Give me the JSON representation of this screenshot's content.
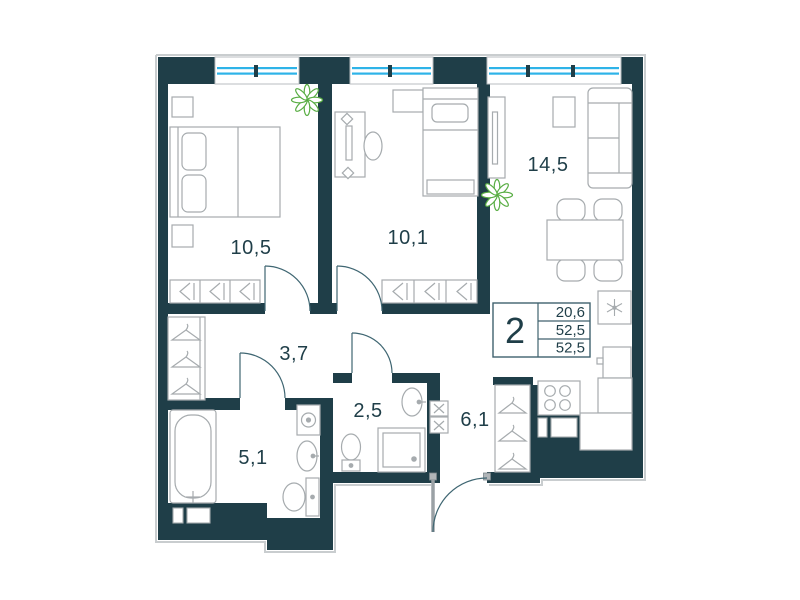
{
  "summary": {
    "rooms_count": "2",
    "area_living": "20,6",
    "area_total": "52,5",
    "area_declared": "52,5"
  },
  "rooms": {
    "bedroom1": {
      "area": "10,5"
    },
    "bedroom2": {
      "area": "10,1"
    },
    "kitchen_living": {
      "area": "14,5"
    },
    "hallway": {
      "area": "3,7"
    },
    "wc": {
      "area": "2,5"
    },
    "corridor": {
      "area": "6,1"
    },
    "bathroom": {
      "area": "5,1"
    }
  },
  "colors": {
    "wall": "#1f3e48",
    "glazing": "#2eb3e8",
    "plant": "#58ad43",
    "fixtures": "#a6abae",
    "text": "#1f3e48"
  },
  "icons": {
    "plant-icon": "✳",
    "snowflake-icon": "❄",
    "hanger-icon": "⌃",
    "washer-icon": "☒"
  }
}
